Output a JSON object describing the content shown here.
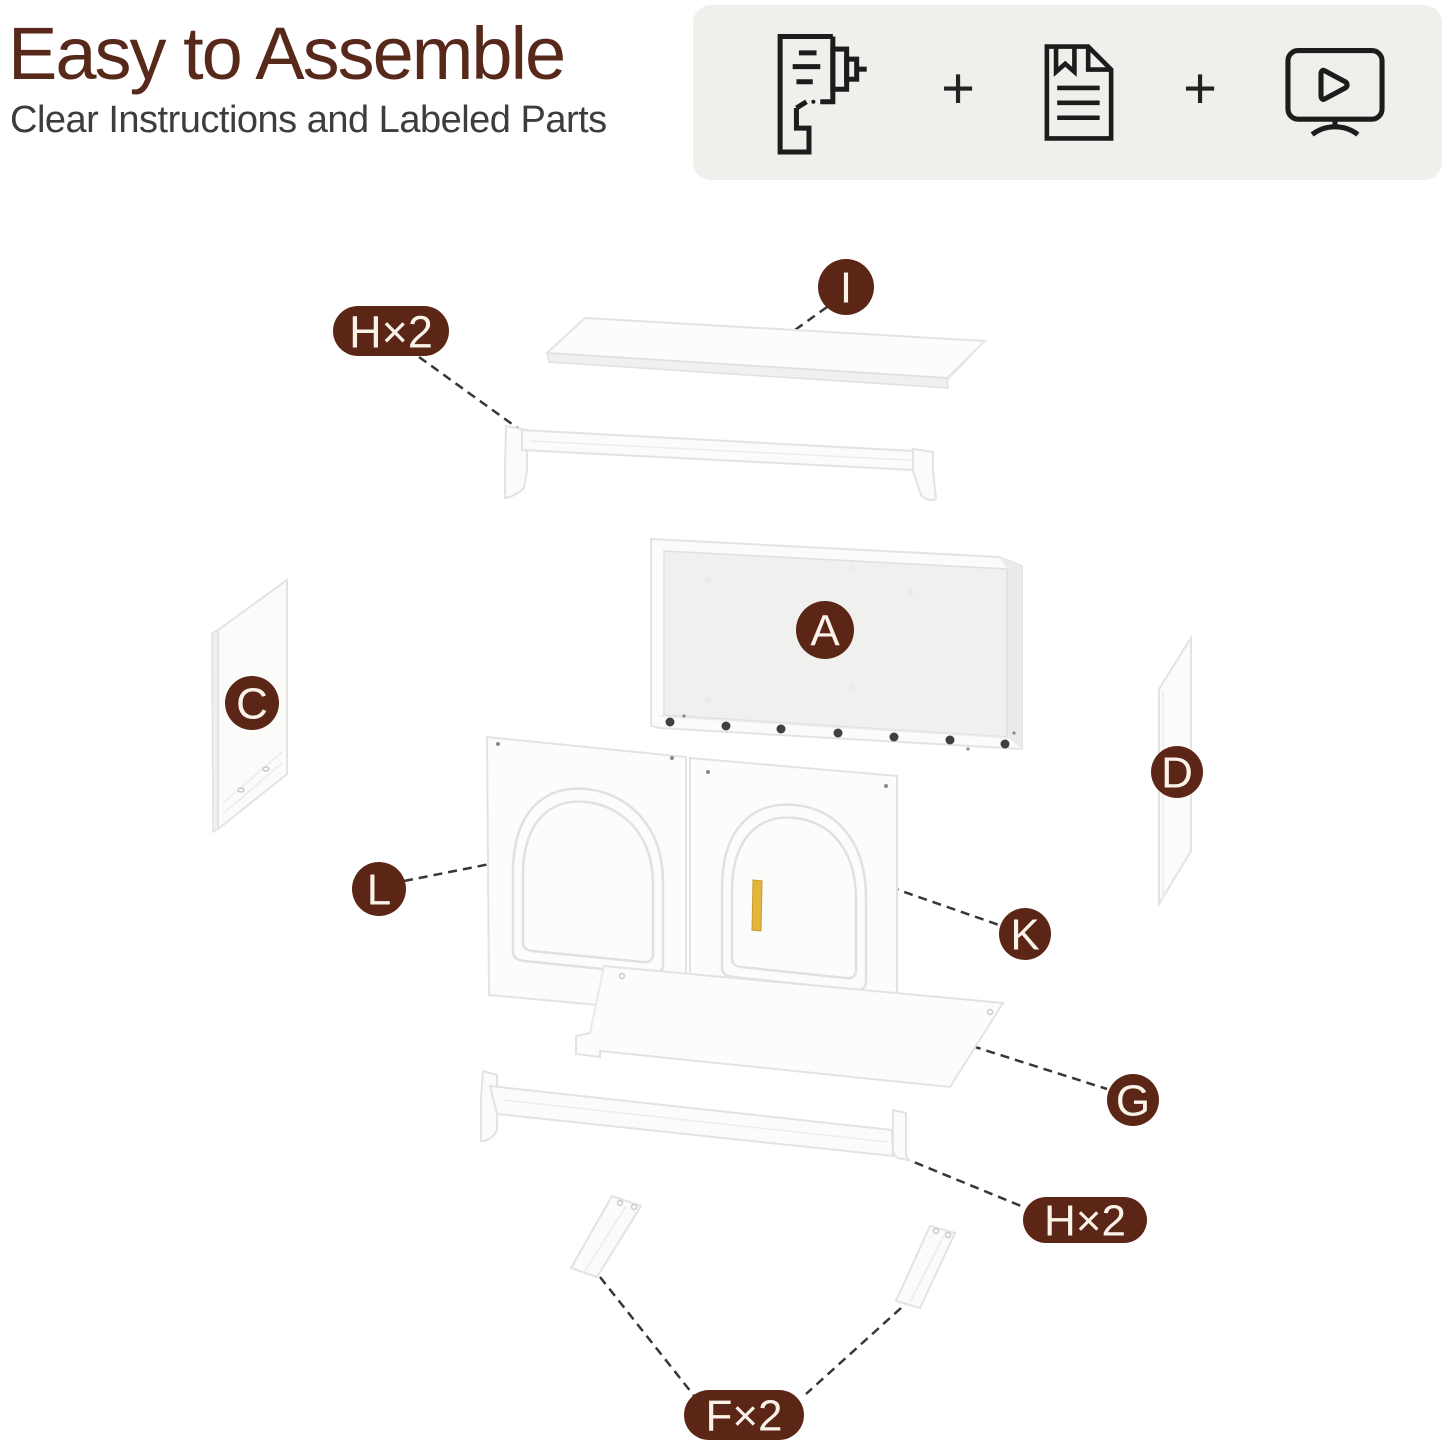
{
  "header": {
    "title": "Easy to Assemble",
    "subtitle": "Clear Instructions and Labeled Parts"
  },
  "toolkit": {
    "plus": "+",
    "icons": [
      "drill-icon",
      "instruction-manual-icon",
      "video-tutorial-icon"
    ]
  },
  "part_labels": {
    "top_shelf": "I",
    "hanging_rod_top": "H×2",
    "back_panel": "A",
    "left_side_panel": "C",
    "right_side_panel": "D",
    "left_door": "L",
    "right_door": "K",
    "bottom_shelf": "G",
    "hanging_rod_bottom": "H×2",
    "mounting_brackets": "F×2"
  },
  "colors": {
    "title_brown": "#57291B",
    "badge_brown": "#5C2616",
    "badge_text": "#FAF3EA",
    "subtitle_gray": "#3D3D3D",
    "toolkit_bg": "#F0EFEC",
    "dashed_line": "#3A3632",
    "handle_gold": "#E5B43C",
    "part_white": "#FBFBFA"
  }
}
